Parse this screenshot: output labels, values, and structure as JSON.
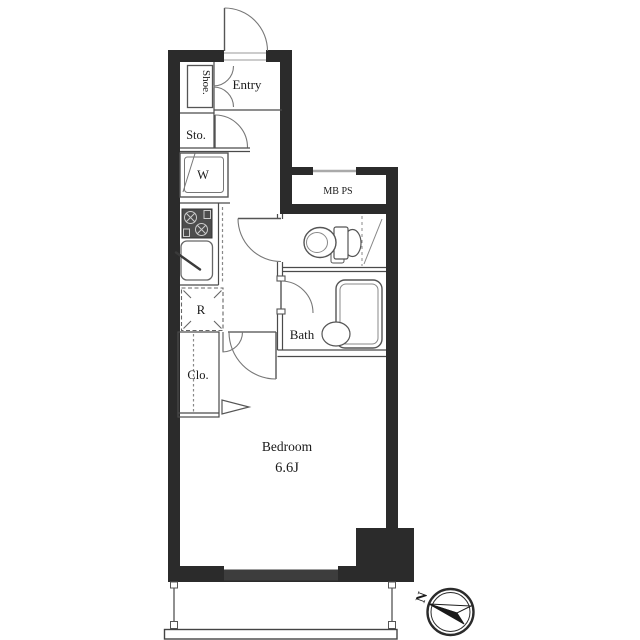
{
  "document": {
    "type": "apartment-floor-plan",
    "background": "#ffffff"
  },
  "rooms": {
    "entry": {
      "label": "Entry"
    },
    "shoe_cabinet": {
      "label": "Shoe."
    },
    "storage": {
      "label": "Sto."
    },
    "washer_pan": {
      "label": "W"
    },
    "meter_box_pipe_space": {
      "label": "MB PS"
    },
    "refrigerator": {
      "label": "R"
    },
    "bath": {
      "label": "Bath"
    },
    "closet": {
      "label": "Clo."
    },
    "bedroom": {
      "label": "Bedroom",
      "size": "6.6J"
    }
  },
  "compass": {
    "north": "N"
  },
  "colors": {
    "wall": "#2b2b2b",
    "window": "#3d3d3d",
    "thin_line": "#4a4a4a",
    "fixture_line": "#666666",
    "light_line": "#999999",
    "text": "#1a1a1a"
  }
}
